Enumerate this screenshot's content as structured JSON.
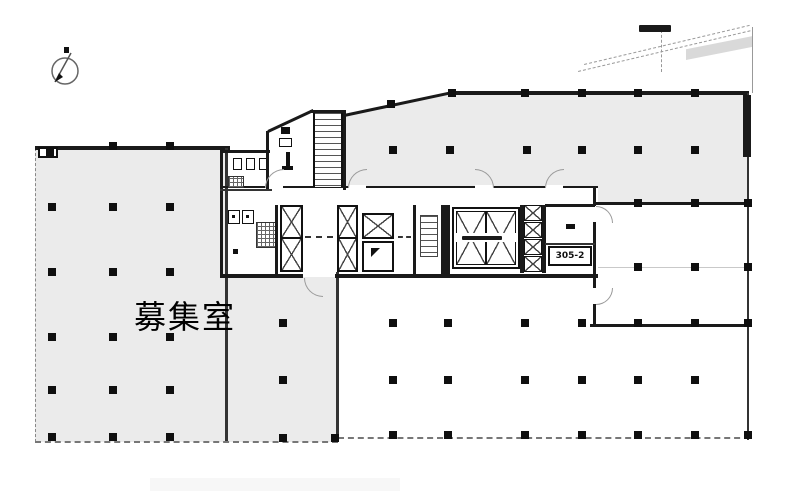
{
  "plan": {
    "vacancy_room_label": "募集室",
    "unit_number_label": "305-2",
    "icons": {
      "compass": "compass-north-icon",
      "elevator_shaft": "elevator-x-icon",
      "stairs": "stair-treads-icon"
    },
    "colors": {
      "background": "#ffffff",
      "shaded_room": "#ebebeb",
      "wall": "#1a1a1a",
      "column": "#0f0f0f",
      "door_arc": "#9a9a9a"
    }
  }
}
